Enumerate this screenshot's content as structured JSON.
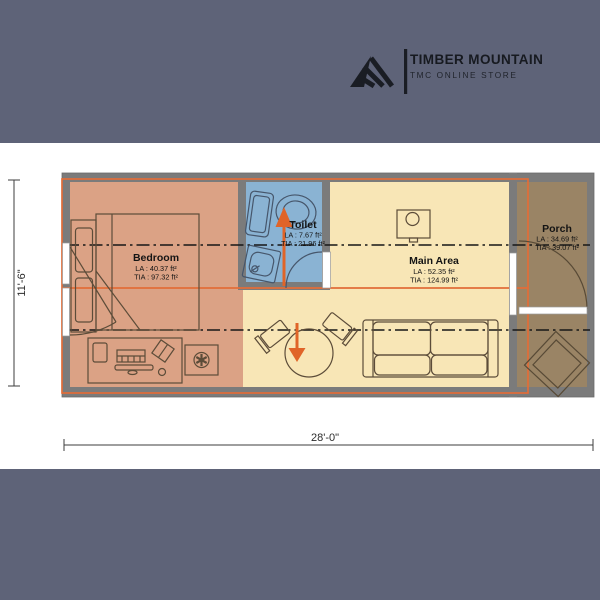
{
  "brand": {
    "title": "TIMBER MOUNTAIN",
    "subtitle": "TMC ONLINE STORE",
    "logo_color": "#1a1d24"
  },
  "floorplan": {
    "rooms": [
      {
        "id": "bedroom",
        "label": "Bedroom",
        "la": "LA : 40.37 ft²",
        "tia": "TIA : 97.32 ft²",
        "color": "#dba285"
      },
      {
        "id": "toilet",
        "label": "Toilet",
        "la": "LA : 7.67 ft²",
        "tia": "TIA : 21.96 ft²",
        "color": "#8ab3d3"
      },
      {
        "id": "main-area",
        "label": "Main Area",
        "la": "LA : 52.35 ft²",
        "tia": "TIA : 124.99 ft²",
        "color": "#f8e6b6"
      },
      {
        "id": "porch",
        "label": "Porch",
        "la": "LA : 34.69 ft²",
        "tia": "TIA : 39.07 ft²",
        "color": "#9a8465"
      }
    ],
    "dimensions": {
      "overall_width": "28'-0\"",
      "overall_height": "11'-6\""
    },
    "colors": {
      "band": "#5e6378",
      "wall": "#7b7b7b",
      "chassis_outline": "#e26d38",
      "arrow": "#e06428"
    }
  }
}
